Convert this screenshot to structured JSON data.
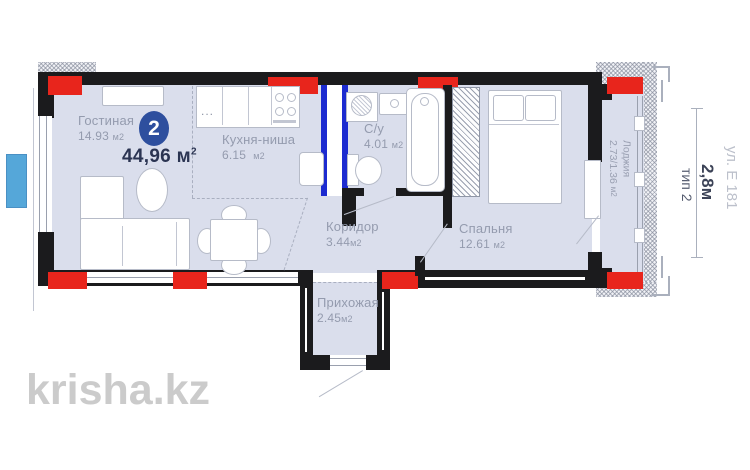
{
  "plan": {
    "summary": {
      "rooms_badge": "2",
      "total": "44,96 м",
      "total_sup": "2"
    },
    "rooms": [
      {
        "name": "Гостиная",
        "value": "14.93",
        "unit": "м2"
      },
      {
        "name": "Кухня-ниша",
        "value": "6.15",
        "unit": "м2"
      },
      {
        "name": "С/у",
        "value": "4.01",
        "unit": "м2"
      },
      {
        "name": "Коридор",
        "value": "3.44",
        "unit": "м2"
      },
      {
        "name": "Спальня",
        "value": "12.61",
        "unit": "м2"
      },
      {
        "name": "Прихожая",
        "value": "2.45",
        "unit": "м2"
      },
      {
        "name": "Лоджия",
        "value": "2.73/1.36",
        "unit": "м2"
      }
    ],
    "annotations": {
      "street": "ул. Е 181",
      "width_dim": "2,8м",
      "plan_type": "тип 2"
    },
    "watermark": "krisha.kz",
    "colors": {
      "wall": "#1b1b1d",
      "floor": "#dadeec",
      "accent_red": "#e8251c",
      "riser_blue": "#1c2bd0",
      "badge_blue": "#2e4f9e",
      "window_marker_blue": "#55a7d9",
      "label_gray": "#949bae",
      "total_navy": "#2b3452",
      "watermark_gray": "#cbcbcb"
    }
  }
}
